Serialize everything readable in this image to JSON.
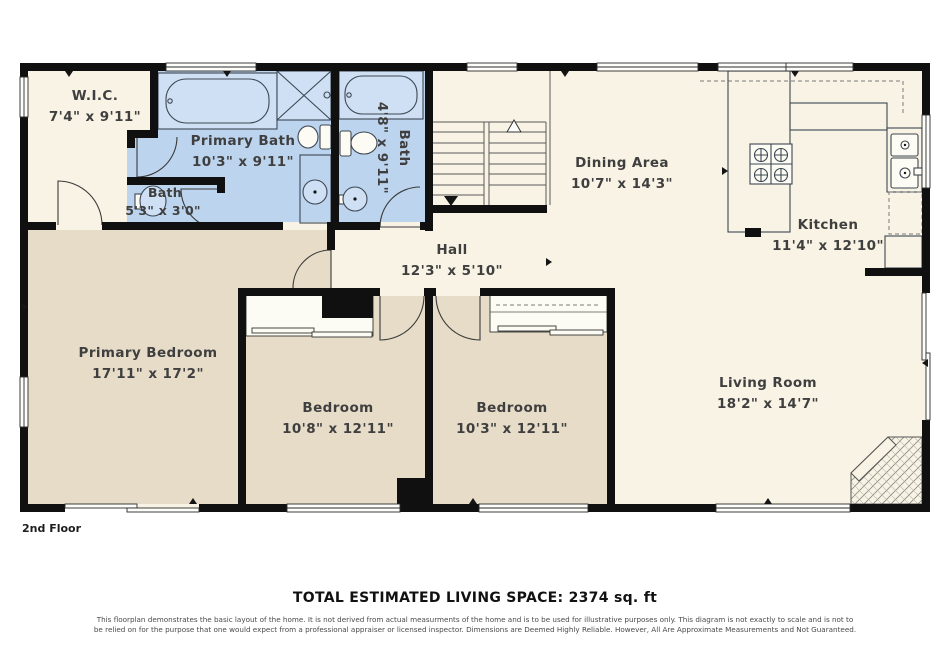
{
  "floor_label": "2nd Floor",
  "total_space_label": "TOTAL ESTIMATED LIVING SPACE: 2374 sq. ft",
  "disclaimer_line1": "This floorplan demonstrates the basic layout of the home. It is not derived from actual measurments of the home and is to be used for illustrative purposes only. This diagram is not exactly to scale and is not to",
  "disclaimer_line2": "be relied on for the purpose that one would expect from a professional appraiser or licensed inspector. Dimensions are Deemed Highly Reliable. However, All Are Approximate Measurements and Not Guaranteed.",
  "colors": {
    "room_cream": "#f8f3e4",
    "bedroom_tan": "#e6dcc8",
    "bath_blue": "#bcd4ee",
    "wall_black": "#101010"
  },
  "rooms": {
    "wic": {
      "name": "W.I.C.",
      "dims": "7'4\" x 9'11\""
    },
    "primary_bath": {
      "name": "Primary Bath",
      "dims": "10'3\" x 9'11\""
    },
    "bath_small": {
      "name": "Bath",
      "dims": "5'3\" x 3'0\""
    },
    "bath_hall": {
      "name": "Bath",
      "dims": "4'8\" x 9'11\""
    },
    "dining": {
      "name": "Dining Area",
      "dims": "10'7\" x 14'3\""
    },
    "kitchen": {
      "name": "Kitchen",
      "dims": "11'4\" x 12'10\""
    },
    "hall": {
      "name": "Hall",
      "dims": "12'3\" x 5'10\""
    },
    "primary_bedroom": {
      "name": "Primary Bedroom",
      "dims": "17'11\" x 17'2\""
    },
    "bedroom_left": {
      "name": "Bedroom",
      "dims": "10'8\" x 12'11\""
    },
    "bedroom_right": {
      "name": "Bedroom",
      "dims": "10'3\" x 12'11\""
    },
    "living": {
      "name": "Living Room",
      "dims": "18'2\" x 14'7\""
    }
  }
}
